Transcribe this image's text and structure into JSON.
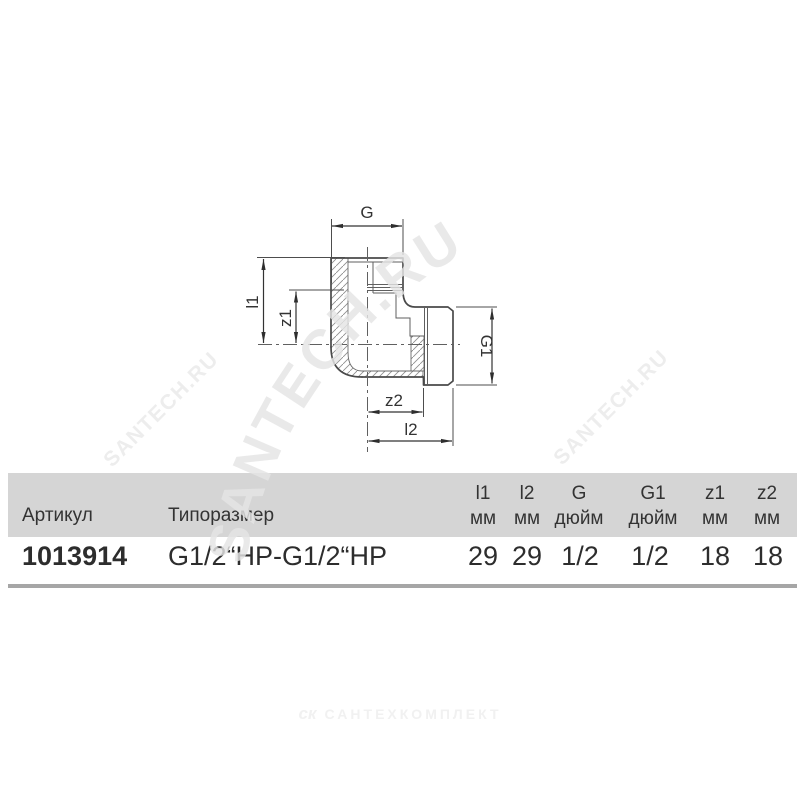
{
  "watermark": {
    "diagonal_text": "SANTECH.RU",
    "color_big": "#e5e5e5",
    "color_small": "#ededed"
  },
  "footer_logo": {
    "mark": "ск",
    "text": "САНТЕХКОМПЛЕКТ",
    "color": "#f1f1f1"
  },
  "diagram": {
    "line_color": "#4a4a4a",
    "labels": {
      "top": "G",
      "left_outer": "l1",
      "left_inner": "z1",
      "right": "G1",
      "bottom_inner": "z2",
      "bottom_outer": "l2"
    }
  },
  "table": {
    "header_bg": "#d5d5d5",
    "article_header": "Артикул",
    "size_header": "Типоразмер",
    "columns": [
      {
        "name": "l1",
        "unit": "мм"
      },
      {
        "name": "l2",
        "unit": "мм"
      },
      {
        "name": "G",
        "unit": "дюйм"
      },
      {
        "name": "G1",
        "unit": "дюйм"
      },
      {
        "name": "z1",
        "unit": "мм"
      },
      {
        "name": "z2",
        "unit": "мм"
      }
    ],
    "row": {
      "article": "1013914",
      "size": "G1/2“НР-G1/2“НР",
      "values": [
        "29",
        "29",
        "1/2",
        "1/2",
        "18",
        "18"
      ]
    }
  }
}
